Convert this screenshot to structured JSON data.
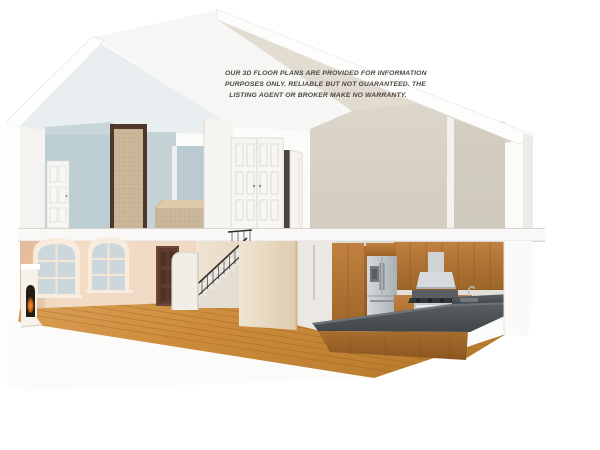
{
  "canvas": {
    "width": 600,
    "height": 450,
    "background": "#ffffff"
  },
  "disclaimer": {
    "lines": [
      "OUR 3D FLOOR PLANS ARE PROVIDED FOR INFORMATION",
      "PURPOSES ONLY. RELIABLE BUT NOT GUARANTEED. THE",
      "LISTING AGENT OR BROKER MAKE NO WARRANTY."
    ],
    "color": "#4d4740"
  },
  "palette": {
    "roof_white": "#fbfbfa",
    "ceiling_pale_blue": "#e9eef0",
    "bedroom_wall_blue": "#bccdd3",
    "gable_cream": "#e2dcd1",
    "right_wall_beige": "#d6d0c5",
    "living_wall_peach": "#f0d9c3",
    "window_pane_blue": "#ccd7db",
    "interior_door_brown": "#5d3c2f",
    "stair_rail_black": "#2f2d2b",
    "partition_beige": "#e8d8c2",
    "wood_floor_orange": "#cd8c3c",
    "cabinet_oak": "#b07434",
    "countertop_gray": "#4e5357",
    "stainless_steel": "#c3c8cb",
    "backsplash_gray": "#dcdbd6",
    "bath_tile_tan": "#cbb89b",
    "kitchen_tile_floor": "#efe8da",
    "fire_glow_orange": "#d9782a"
  }
}
